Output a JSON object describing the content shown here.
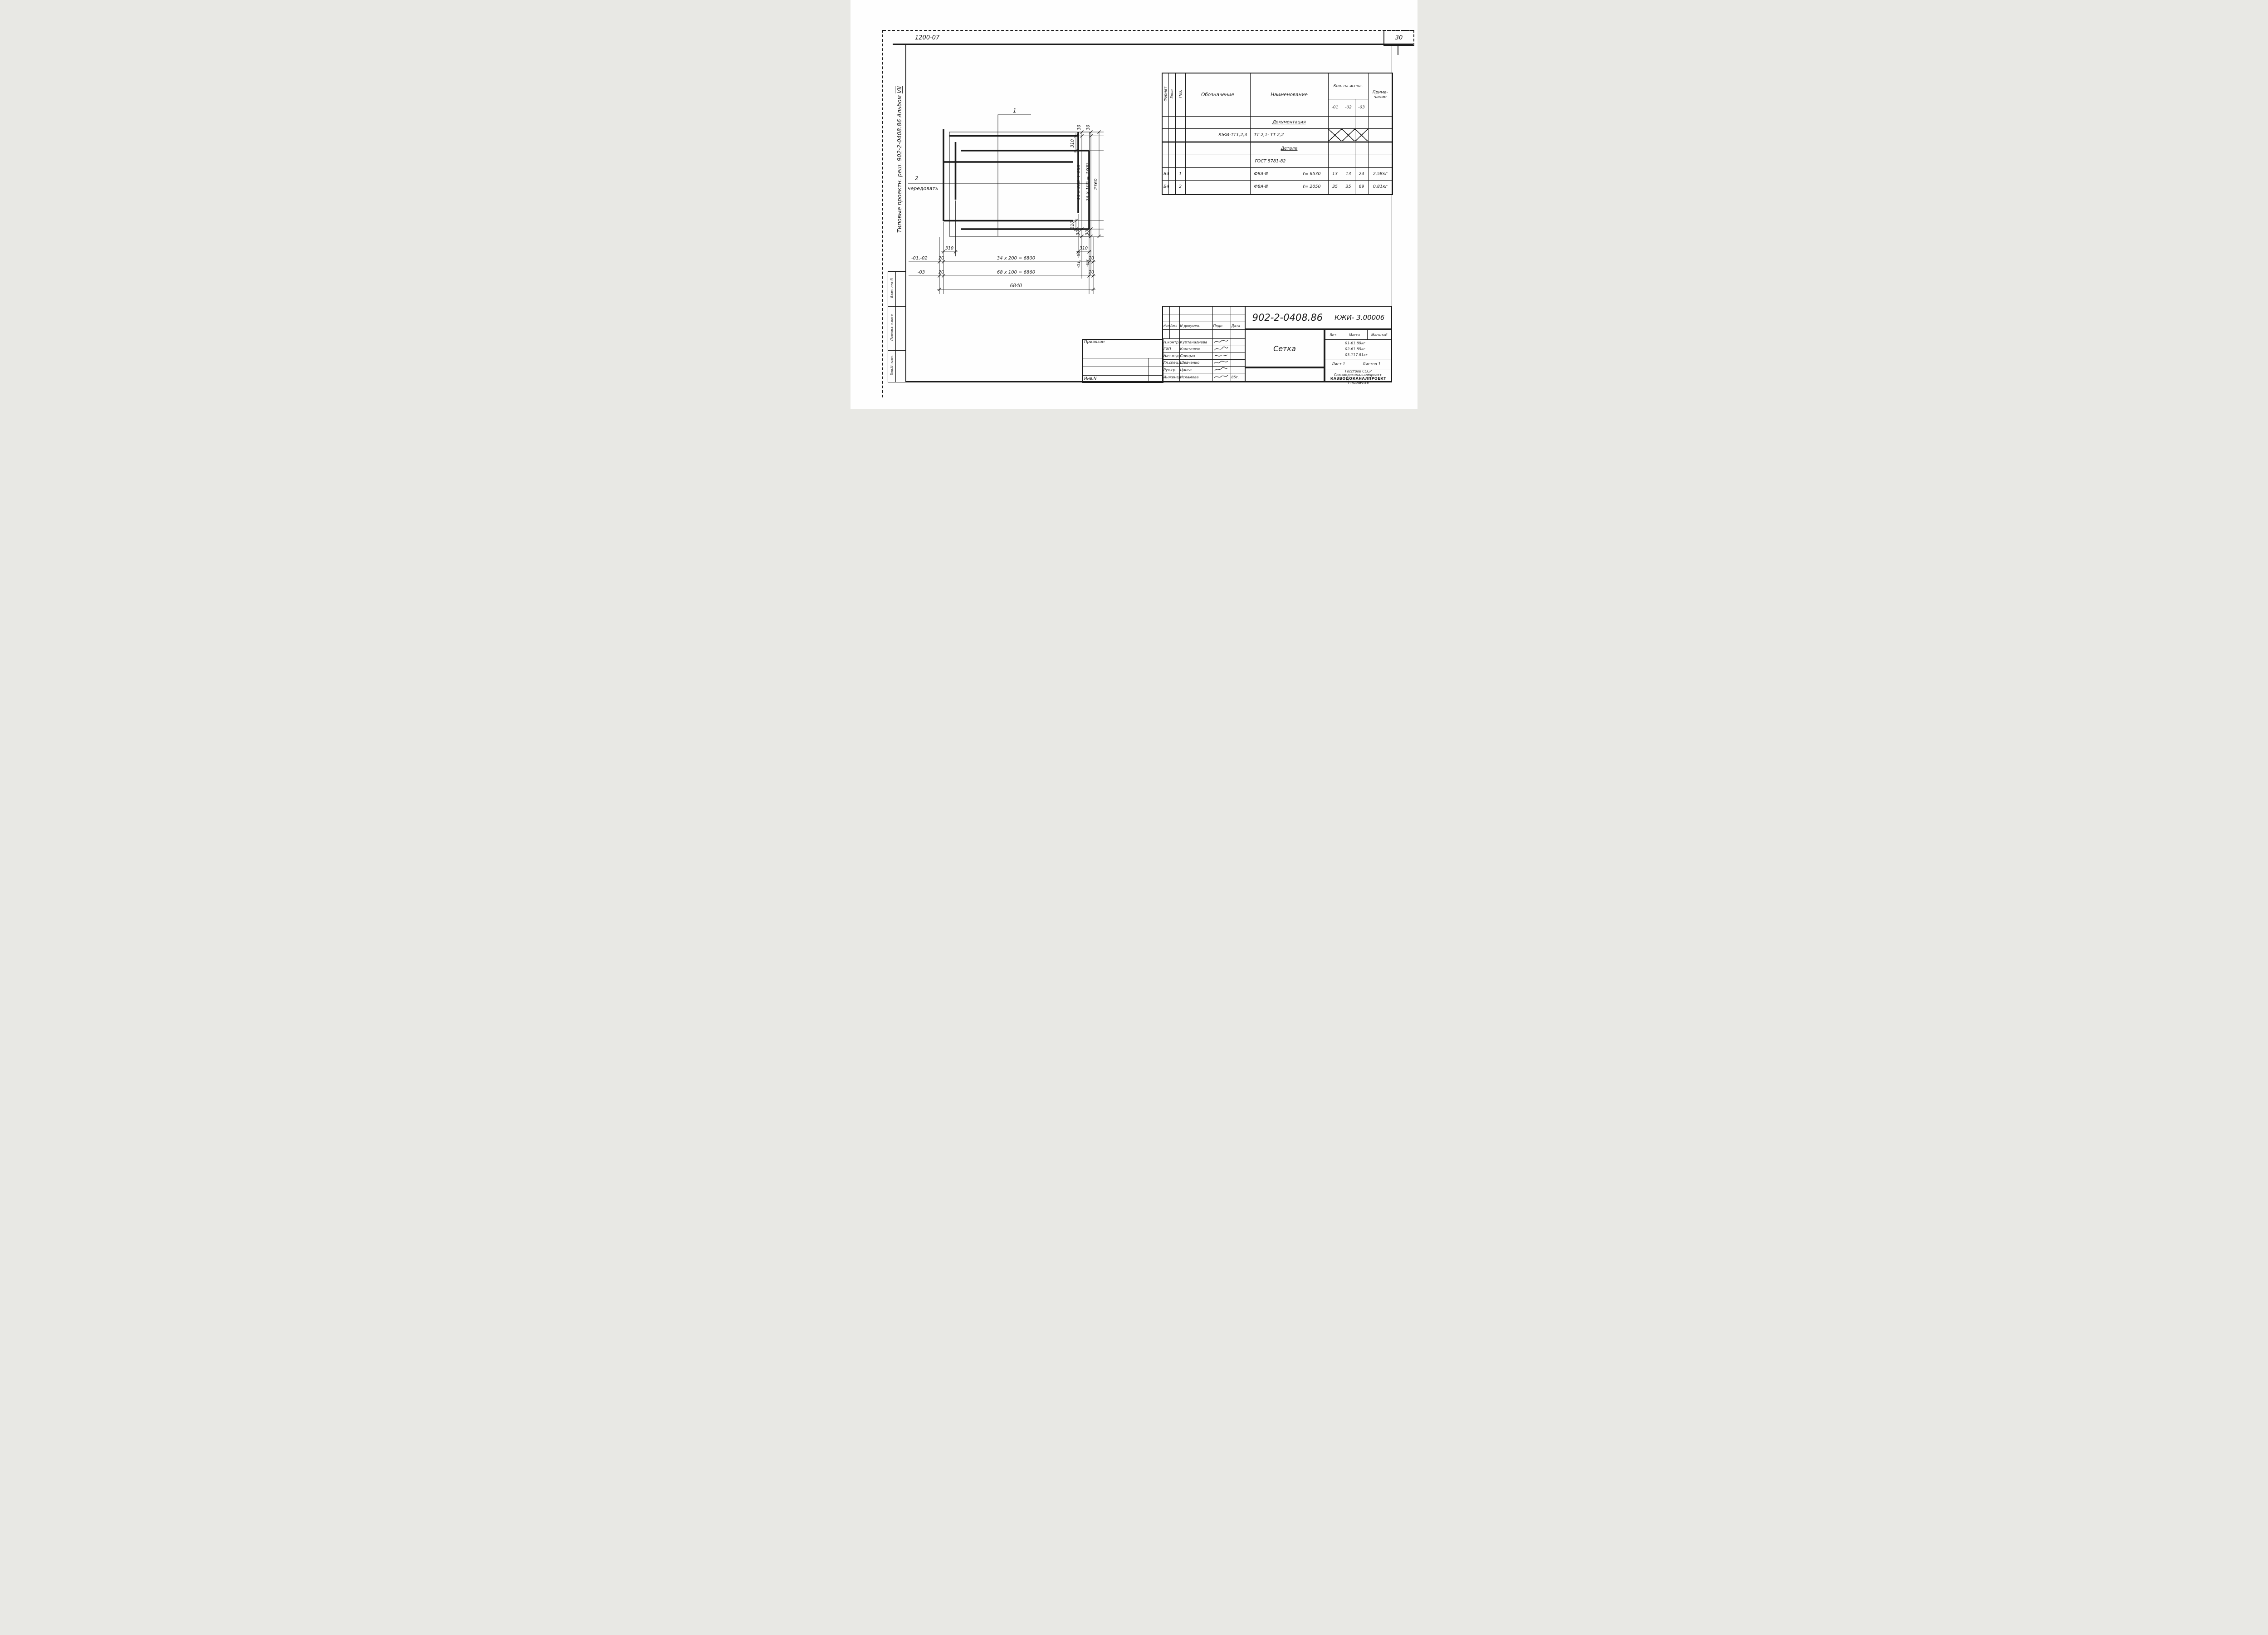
{
  "sheet": {
    "code": "1200-07",
    "page": "30"
  },
  "margin": {
    "album": "Типовые проектн. реш. 902-2-0408.86 Альбом ",
    "album_roman": "VII",
    "boxes": [
      "Взам. инв.N",
      "Подпись и дата",
      "Инв.N подл."
    ]
  },
  "drawing": {
    "callout1": "1",
    "callout2": "2",
    "callout2_note": "чередовать",
    "dim_30_a": "30",
    "dim_30_b": "30",
    "dim_310_top_right": "310",
    "dim_310_bottom_right": "310",
    "chain1_text": "11 x 200 + 100",
    "chain1_label": "-01, -02",
    "chain1_30_bottom": "30",
    "chain2_text": "23 x 100 = 2300",
    "chain2_label": "-03",
    "chain2_30_bottom": "30",
    "total_vertical": "2360",
    "dim_310_bottom_left": "310",
    "dim_310_bottom_mid": "310",
    "row1_label": "-01,-02",
    "row1_a": "20",
    "row1_b": "34 x 200 = 6800",
    "row1_c": "20",
    "row2_label": "-03",
    "row2_a": "20",
    "row2_b": "68 x 100 = 6860",
    "row2_c": "20",
    "total_horizontal": "6840"
  },
  "spec": {
    "h_format": "Формат",
    "h_zone": "Зона",
    "h_poz": "Поз.",
    "h_obozn": "Обозначение",
    "h_naimen": "Наименование",
    "h_kol": "Кол. на испол.",
    "h_k1": "-01",
    "h_k2": "-02",
    "h_k3": "-03",
    "h_prim1": "Приме-",
    "h_prim2": "чание",
    "rows": [
      {
        "naimen": "Документация"
      },
      {
        "obozn": "КЖИ-ТТ1,2,3",
        "naimen": "ТТ 2,1- ТТ 2,2"
      },
      {},
      {
        "naimen": "Детали"
      },
      {
        "naimen": "ГОСТ 5781-82"
      },
      {
        "format": "Б4",
        "poz": "1",
        "naimen": "Ф8А-Ⅲ",
        "len": "ℓ= 6530",
        "k1": "13",
        "k2": "13",
        "k3": "24",
        "prim": "2,58кг"
      },
      {
        "format": "Б4",
        "poz": "2",
        "naimen": "Ф8А-Ⅲ",
        "len": "ℓ= 2050",
        "k1": "35",
        "k2": "35",
        "k3": "69",
        "prim": "0,81кг"
      },
      {}
    ]
  },
  "tb": {
    "doc": "902-2-0408.86",
    "code": "КЖИ- 3.00006",
    "name": "Сетка",
    "h_izm": "Изм",
    "h_list": "Лист",
    "h_ndoc": "N докумен.",
    "h_podp": "Подп.",
    "h_data": "Дата",
    "rows": [
      {
        "role": "Н.контр.",
        "name": "Куртаналиева"
      },
      {
        "role": "ГИП",
        "name": "Каштелюк"
      },
      {
        "role": "Нач.отд.",
        "name": "Спицын"
      },
      {
        "role": "Гл.спец.",
        "name": "Шевченко"
      },
      {
        "role": "Рук.гр.",
        "name": "Цанга"
      },
      {
        "role": "Инженер.",
        "name": "Исламова",
        "date": "85г."
      }
    ],
    "h_lit": "Лит.",
    "h_mass": "Масса",
    "h_scale": "Масштаб",
    "mass1": "01-61.89кг",
    "mass2": "02-61.89кг",
    "mass3": "03-117.81кг",
    "list": "Лист 1",
    "listov": "Листов 1",
    "org1": "Госстрой СССР",
    "org2": "Союзводоканалниипроект.",
    "org3": "КАЗВОДОКАНАЛПРОЕКТ",
    "org4": "г. Алма-Ата",
    "attach": "Привязан",
    "inv": "Инв.N"
  }
}
